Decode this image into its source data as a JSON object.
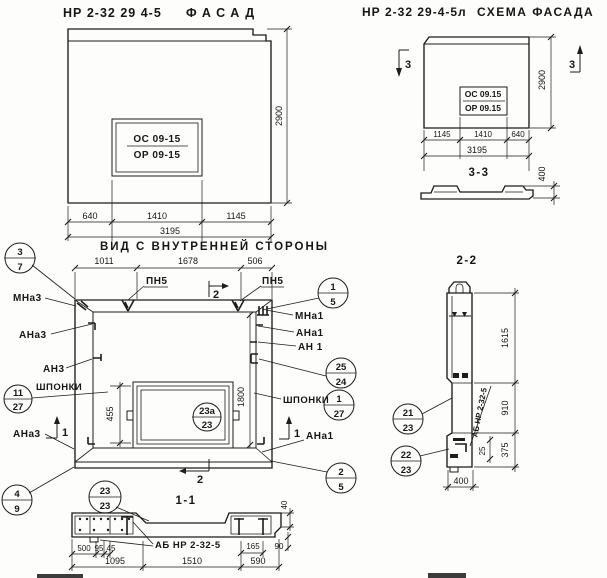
{
  "facade": {
    "title_code": "НР 2-32 29 4-5",
    "title_name": "ФАСАД",
    "win_top": "ОС 09-15",
    "win_bot": "ОР 09-15",
    "dim_height": "2900",
    "dim_b1": "640",
    "dim_b2": "1410",
    "dim_b3": "1145",
    "dim_total": "3195"
  },
  "schema": {
    "title_code": "НР 2-32 29-4-5л",
    "title_name": "СХЕМА ФАСАДА",
    "win_top": "ОС 09.15",
    "win_bot": "ОР 09.15",
    "marker_left": "3",
    "marker_right": "3",
    "dim_height": "2900",
    "dim_b1": "1145",
    "dim_b2": "1410",
    "dim_b3": "640",
    "dim_total": "3195"
  },
  "sec33": {
    "title": "3-3",
    "dim_depth": "400"
  },
  "inner": {
    "title": "ВИД С ВНУТРЕННЕЙ СТОРОНЫ",
    "dim_t1": "1011",
    "dim_t2": "1678",
    "dim_t3": "506",
    "pn5_left": "ПН5",
    "pn5_right": "ПН5",
    "marker_top": "2",
    "marker_bottom": "2",
    "marker_left": "1",
    "marker_right": "1",
    "mna3": "МНа3",
    "ana3": "АНа3",
    "an3": "АН3",
    "shponki_left": "ШПОНКИ",
    "ana3_bottom": "АНа3",
    "mna1": "МНа1",
    "ana1": "АНа1",
    "an1": "АН 1",
    "shponki_right": "ШПОНКИ",
    "ana1_bottom": "АНа1",
    "dim_window": "455",
    "dim_inner_h": "1800",
    "c37": {
      "t": "3",
      "b": "7"
    },
    "c1127": {
      "t": "11",
      "b": "27"
    },
    "c49": {
      "t": "4",
      "b": "9"
    },
    "c15": {
      "t": "1",
      "b": "5"
    },
    "c2524": {
      "t": "25",
      "b": "24"
    },
    "c127": {
      "t": "1",
      "b": "27"
    },
    "c25": {
      "t": "2",
      "b": "5"
    },
    "c23a": {
      "t": "23а",
      "b": "23"
    }
  },
  "sec11": {
    "title": "1-1",
    "c2323": {
      "t": "23",
      "b": "23"
    },
    "label": "АБ НР 2-32-5",
    "d500": "500",
    "d95": "95",
    "d45": "45",
    "d1095": "1095",
    "d1510": "1510",
    "d590": "590",
    "d165": "165",
    "d90": "90",
    "d40": "40"
  },
  "sec22": {
    "title": "2-2",
    "c2123": {
      "t": "21",
      "b": "23"
    },
    "c2223": {
      "t": "22",
      "b": "23"
    },
    "label": "АБ НР 2-32-5",
    "d1615": "1615",
    "d910": "910",
    "d375": "375",
    "d400": "400",
    "d25": "25"
  }
}
